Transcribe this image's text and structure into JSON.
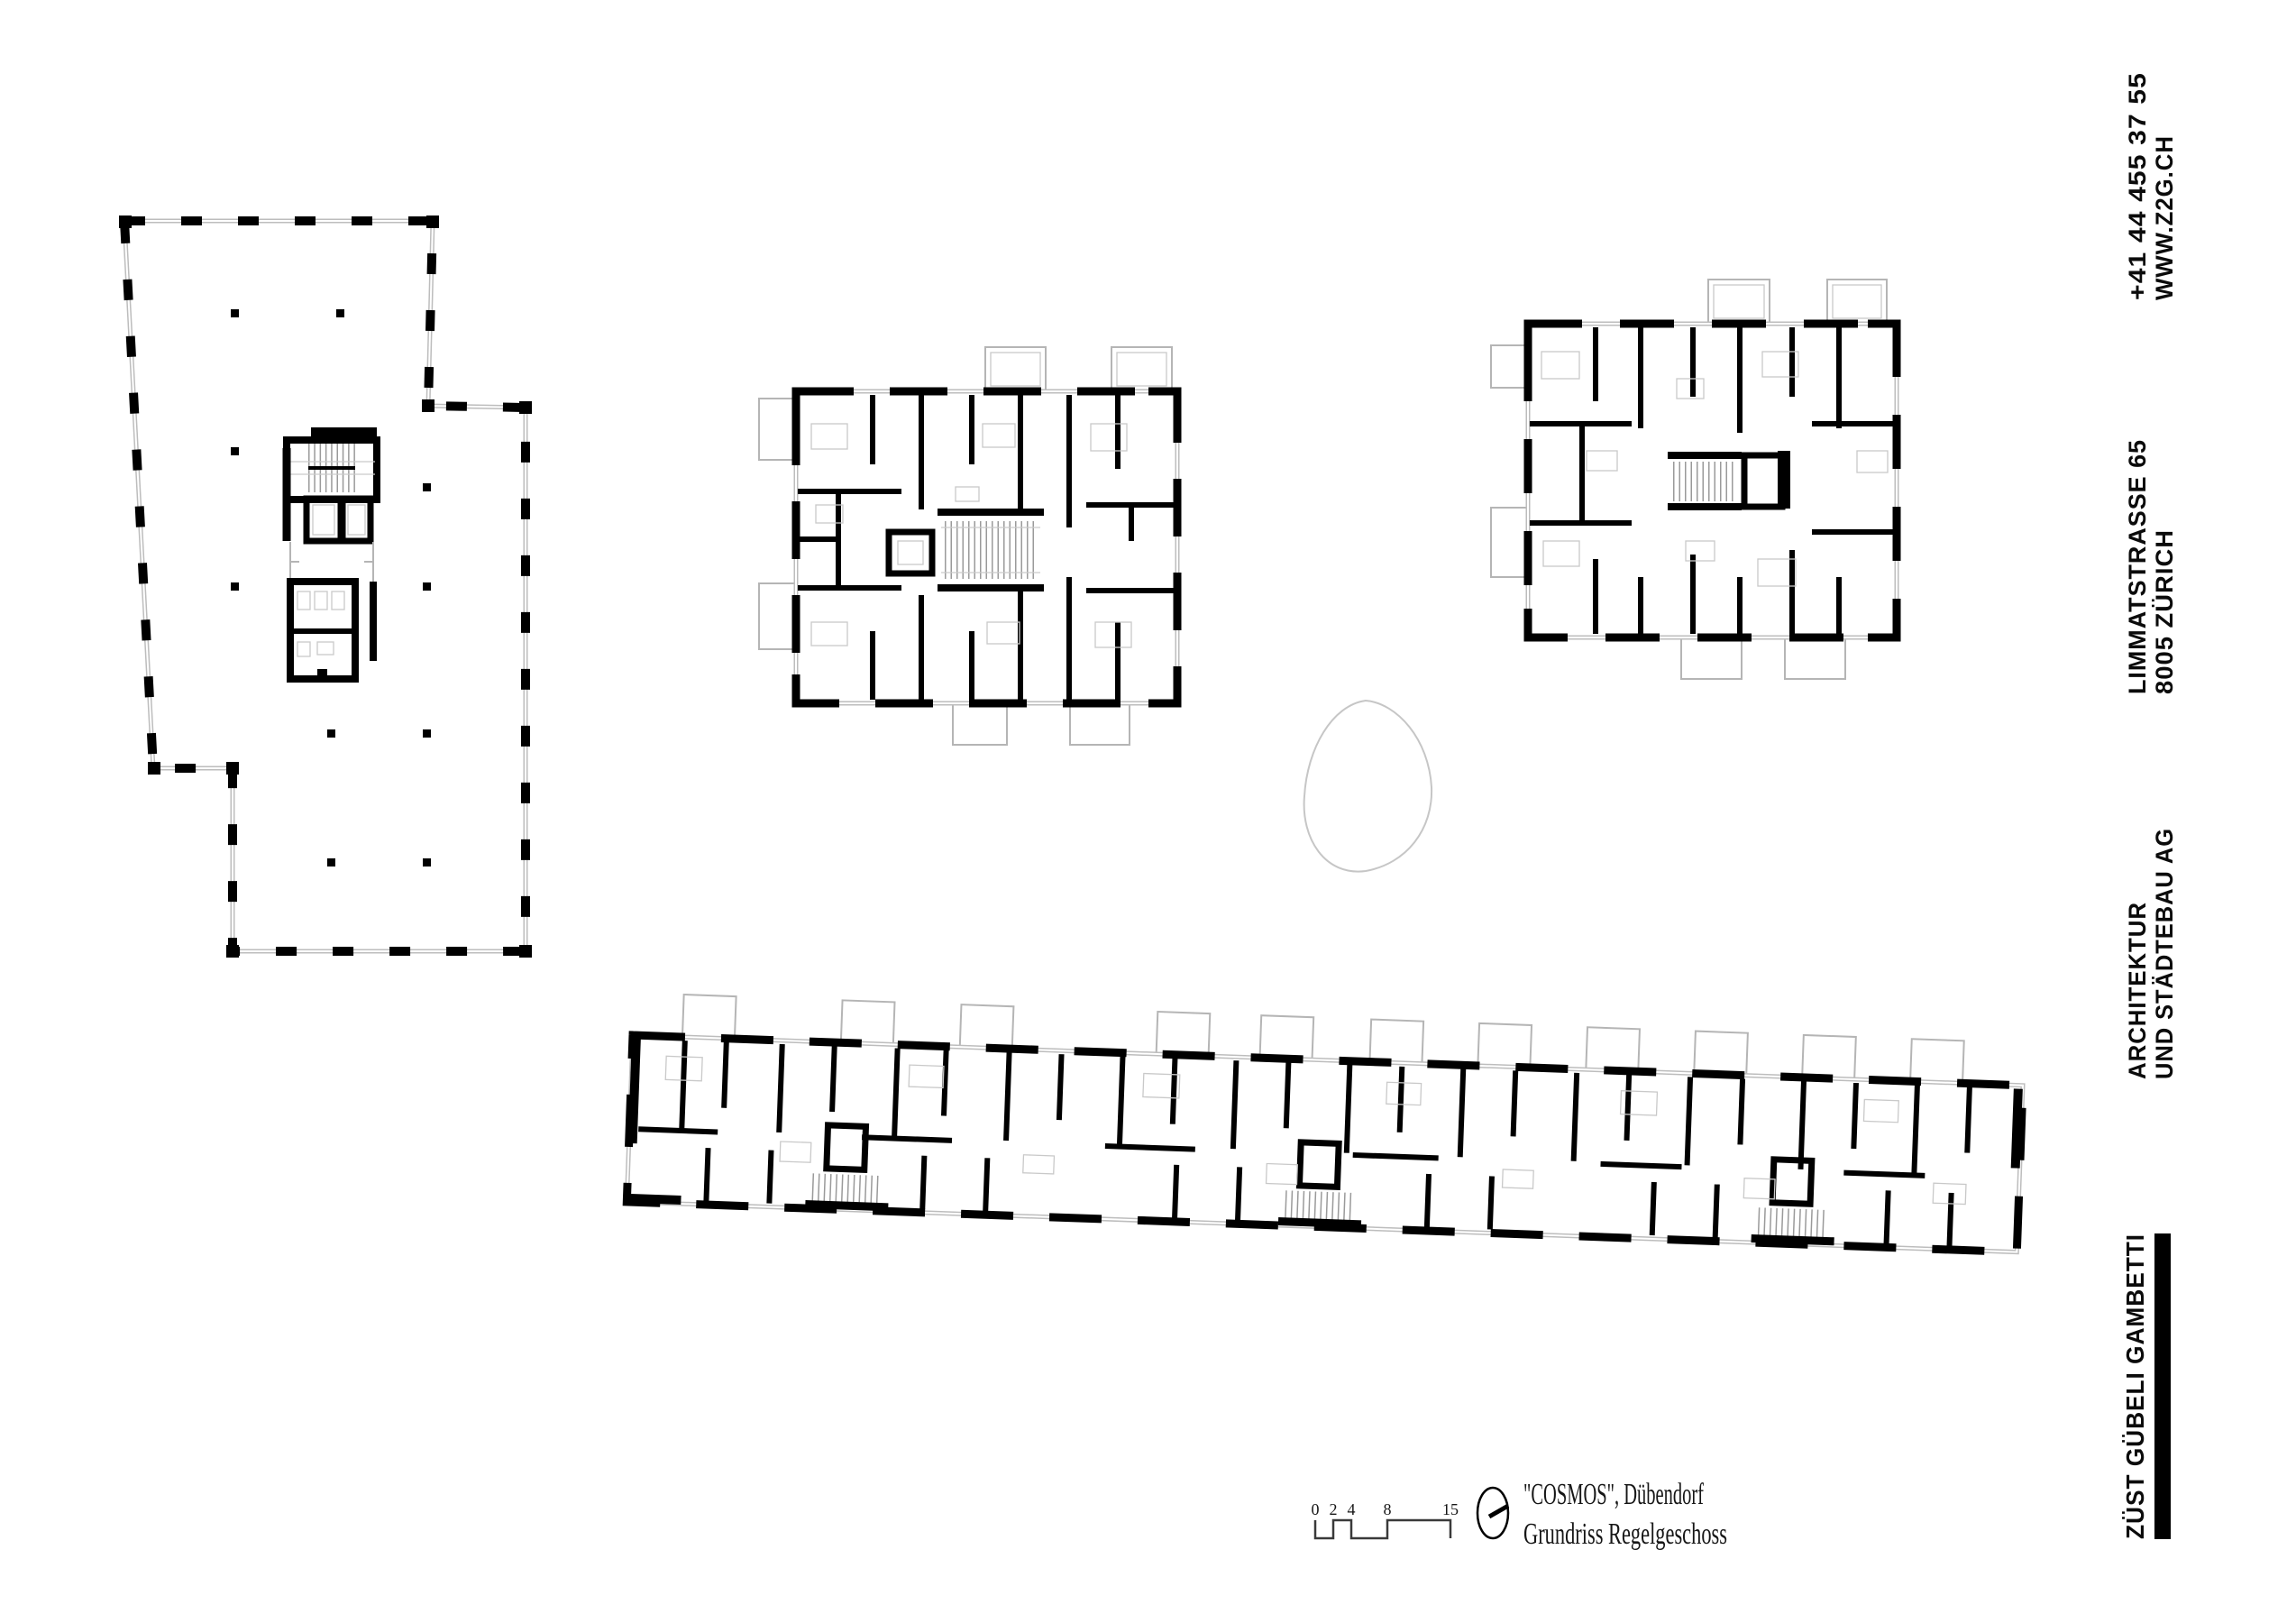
{
  "sidebar": {
    "contact": {
      "line1": "+41 44 455 37 55",
      "line2": "WWW.Z2G.CH"
    },
    "address": {
      "line1": "LIMMATSTRASSE 65",
      "line2": "8005 ZÜRICH"
    },
    "firm": {
      "line1": "ARCHITEKTUR",
      "line2": "UND STÄDTEBAU AG"
    },
    "brand": "ZÜST GÜBELI GAMBETTI"
  },
  "title_block": {
    "project": "\"COSMOS\", Dübendorf",
    "drawing": "Grundriss Regelgeschoss"
  },
  "scale_bar": {
    "labels": [
      "0",
      "2",
      "4",
      "8",
      "15"
    ]
  },
  "icons": {
    "north": "north-indicator"
  },
  "colors": {
    "ink": "#000000",
    "line_light": "#bdbdbd"
  }
}
